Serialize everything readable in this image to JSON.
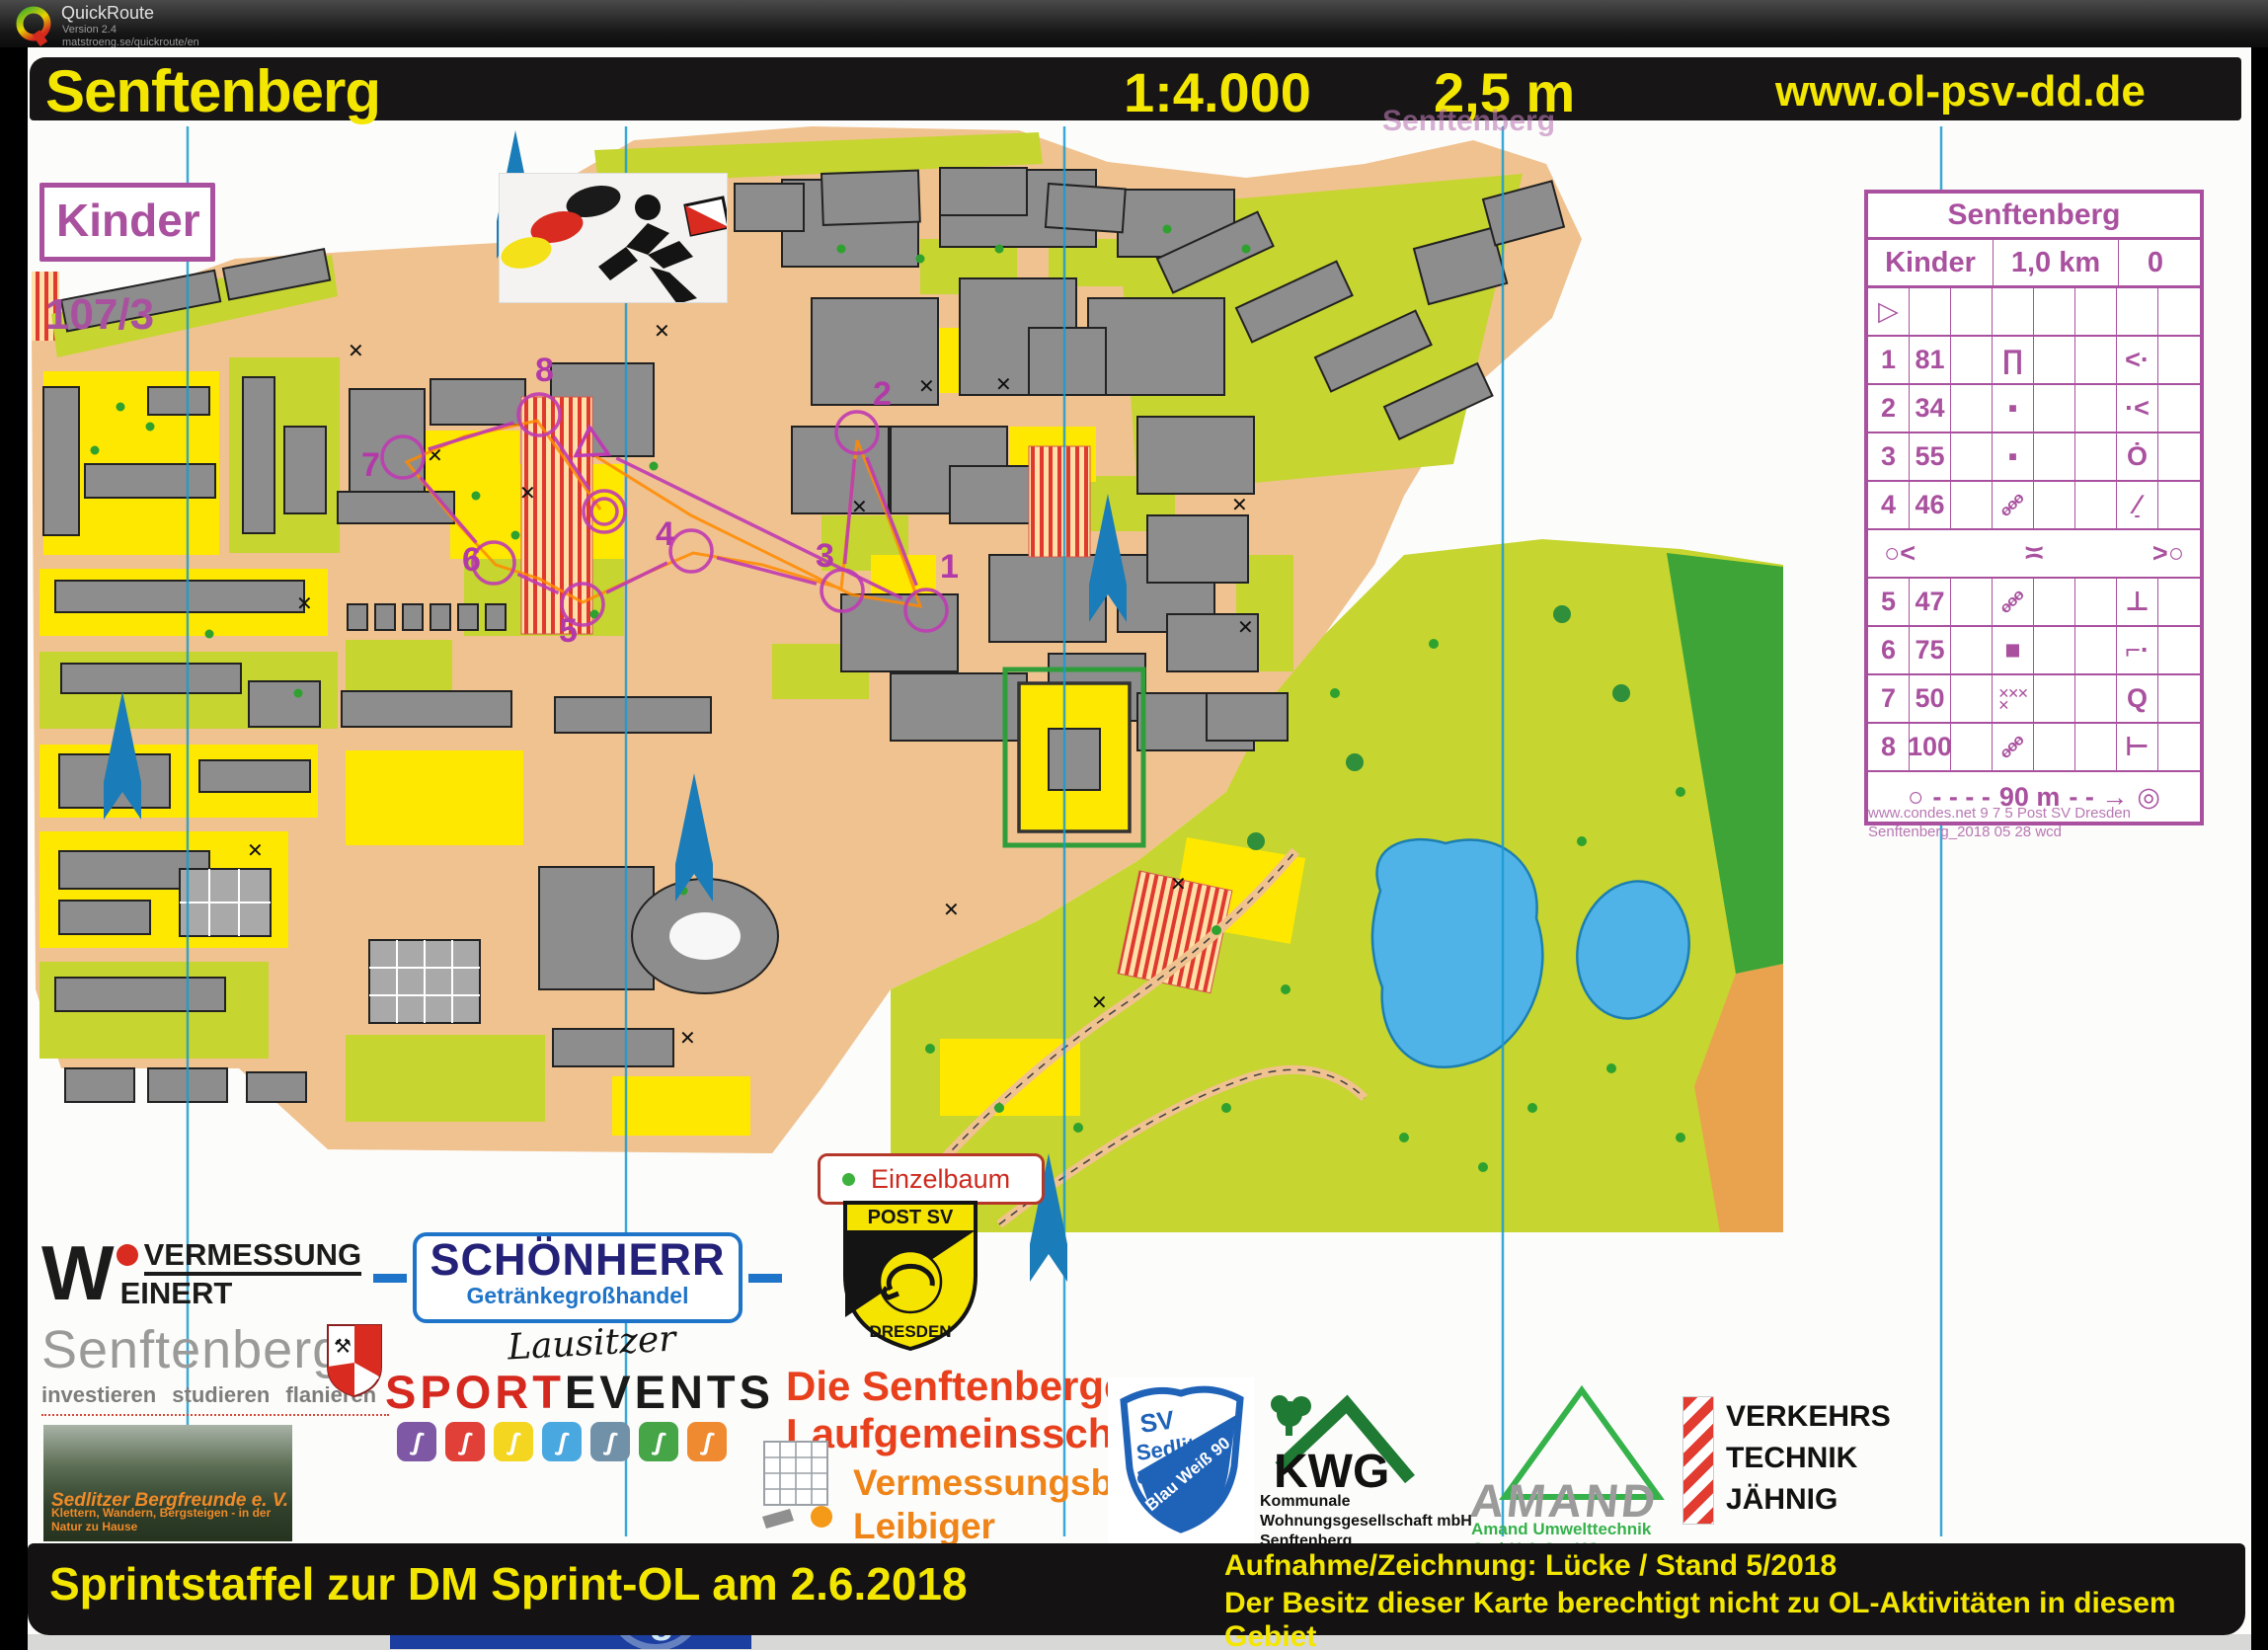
{
  "app": {
    "name": "QuickRoute",
    "version": "Version 2.4",
    "site": "matstroeng.se/quickroute/en"
  },
  "title_band": {
    "title": "Senftenberg",
    "scale": "1:4.000",
    "equidistance": "2,5 m",
    "website": "www.ol-psv-dd.de",
    "ghost_title": "Senftenberg"
  },
  "course": {
    "class_label": "Kinder",
    "relay_leg": "107/3"
  },
  "map": {
    "controls": [
      {
        "label": "1"
      },
      {
        "label": "2"
      },
      {
        "label": "3"
      },
      {
        "label": "4"
      },
      {
        "label": "5"
      },
      {
        "label": "6"
      },
      {
        "label": "7"
      },
      {
        "label": "8"
      }
    ],
    "legend": {
      "single_tree": "Einzelbaum"
    }
  },
  "control_sheet": {
    "event": "Senftenberg",
    "class_label": "Kinder",
    "length": "1,0 km",
    "climb": "0",
    "rows": [
      {
        "type": "start"
      },
      {
        "type": "control",
        "num": "1",
        "code": "81",
        "d": "canopy",
        "g": "angle-dot"
      },
      {
        "type": "control",
        "num": "2",
        "code": "34",
        "d": "boulder-small",
        "g": "dot-angle"
      },
      {
        "type": "control",
        "num": "3",
        "code": "55",
        "d": "boulder-small",
        "g": "circle-dot"
      },
      {
        "type": "control",
        "num": "4",
        "code": "46",
        "d": "fence",
        "g": "slash-foot"
      },
      {
        "type": "spectator",
        "left": "circle-angle",
        "mid": "crossing",
        "right": "angle-circle"
      },
      {
        "type": "control",
        "num": "5",
        "code": "47",
        "d": "fence",
        "g": "tee-down"
      },
      {
        "type": "control",
        "num": "6",
        "code": "75",
        "d": "boulder",
        "g": "corner-dot"
      },
      {
        "type": "control",
        "num": "7",
        "code": "50",
        "d": "hatch",
        "g": "circle-tail"
      },
      {
        "type": "control",
        "num": "8",
        "code": "100",
        "d": "fence",
        "g": "tee-right"
      }
    ],
    "finish_distance": "90 m",
    "credit1": "www.condes.net 9 7 5 Post SV Dresden",
    "credit2": "Senftenberg_2018 05 28 wcd"
  },
  "sponsors": {
    "weinert": {
      "initial": "W",
      "top": "VERMESSUNG",
      "bottom": "EINERT"
    },
    "city": {
      "name": "Senftenberg",
      "slogan": "investieren studieren flanieren"
    },
    "bergfreunde": {
      "name": "Sedlitzer Bergfreunde e. V.",
      "slogan": "Klettern, Wandern, Bergsteigen - in der Natur zu Hause"
    },
    "schoenherr": {
      "name": "SCHÖNHERR",
      "sub": "Getränkegroßhandel"
    },
    "lausitzer": "Lausitzer",
    "sportevents": {
      "red": "SPORT",
      "black": "EVENTS",
      "icon_colors": [
        "#7e57a5",
        "#e04038",
        "#f4d520",
        "#4aa8e0",
        "#7191a8",
        "#46a546",
        "#f08a30"
      ]
    },
    "timing": {
      "tagline": "Wir haben Ihre Zeit",
      "domain": "lausitz-timing.de"
    },
    "postsv": {
      "top": "POST SV",
      "bottom": "DRESDEN"
    },
    "laufgemeinschaft": {
      "line1": "Die Senftenberger",
      "line2": "Laufgemeinsschaft"
    },
    "leibiger": {
      "line1": "Vermessungsbüro",
      "line2": "Leibiger"
    },
    "sedlitz": {
      "sv": "SV",
      "name": "Sedlitz",
      "ev": "e.V.",
      "ribbon": "Blau Weiß 90"
    },
    "kwg": {
      "name": "KWG",
      "lines": [
        "Kommunale",
        "Wohnungsgesellschaft mbH",
        "Senftenberg"
      ]
    },
    "amand": {
      "name": "AMAND",
      "sub": "Amand Umwelttechnik GmbH & Co. KG"
    },
    "jaehnig": {
      "lines": [
        "VERKEHRS",
        "TECHNIK",
        "JÄHNIG"
      ]
    }
  },
  "footer": {
    "event": "Sprintstaffel zur DM Sprint-OL am 2.6.2018",
    "credit": "Aufnahme/Zeichnung: Lücke  / Stand 5/2018",
    "notice": "Der Besitz dieser Karte berechtigt nicht zu OL-Aktivitäten in diesem Gebiet"
  },
  "colors": {
    "overprint_purple": "#bf3bb3",
    "sheet_purple": "#a9519f",
    "title_yellow": "#f3e600",
    "map_tan": "#f0c28f",
    "map_yellow": "#ffe800",
    "map_olive": "#c6d52f",
    "meridian_blue": "#1a9bd0",
    "north_arrow_blue": "#1a7cb8",
    "route_orange": "#ff8a00"
  }
}
